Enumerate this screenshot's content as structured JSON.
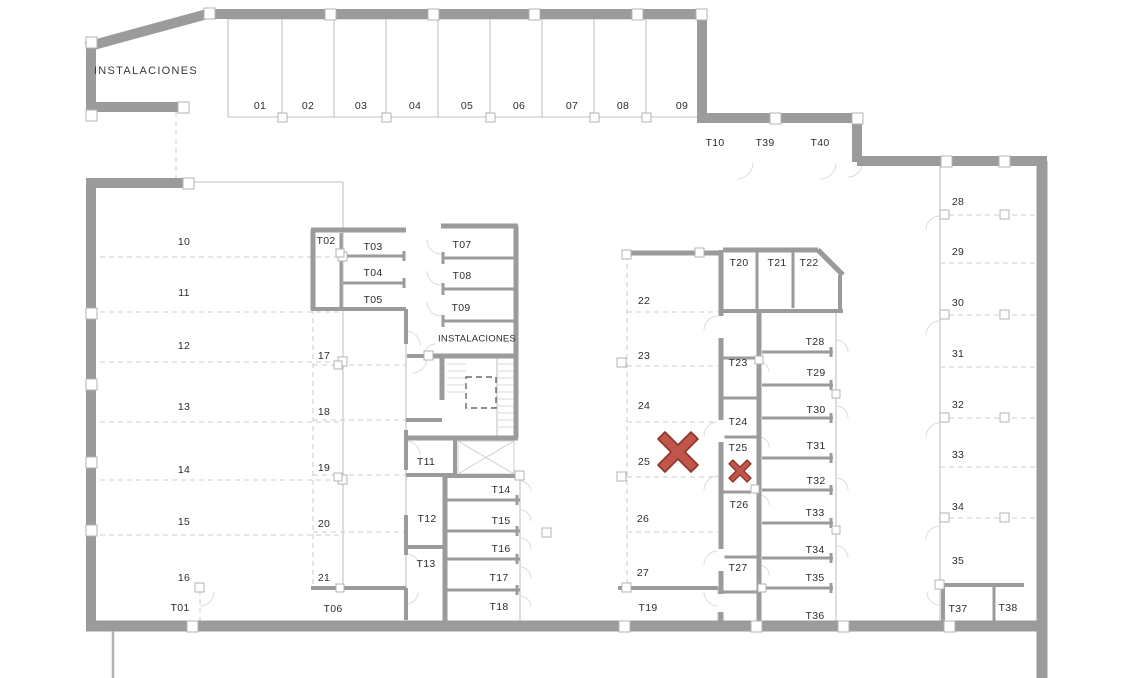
{
  "colors": {
    "wall": "#9b9b9b",
    "thin_line": "#c2c2c2",
    "marker_fill": "#c0564b",
    "marker_stroke": "#8d362d"
  },
  "labels": {
    "instalaciones_top": "INSTALACIONES",
    "instalaciones_mid": "INSTALACIONES",
    "p01": "01",
    "p02": "02",
    "p03": "03",
    "p04": "04",
    "p05": "05",
    "p06": "06",
    "p07": "07",
    "p08": "08",
    "p09": "09",
    "p10": "10",
    "p11": "11",
    "p12": "12",
    "p13": "13",
    "p14": "14",
    "p15": "15",
    "p16": "16",
    "p17": "17",
    "p18": "18",
    "p19": "19",
    "p20": "20",
    "p21": "21",
    "p22": "22",
    "p23": "23",
    "p24": "24",
    "p25": "25",
    "p26": "26",
    "p27": "27",
    "p28": "28",
    "p29": "29",
    "p30": "30",
    "p31": "31",
    "p32": "32",
    "p33": "33",
    "p34": "34",
    "p35": "35",
    "t01": "T01",
    "t02": "T02",
    "t03": "T03",
    "t04": "T04",
    "t05": "T05",
    "t06": "T06",
    "t07": "T07",
    "t08": "T08",
    "t09": "T09",
    "t10": "T10",
    "t11": "T11",
    "t12": "T12",
    "t13": "T13",
    "t14": "T14",
    "t15": "T15",
    "t16": "T16",
    "t17": "T17",
    "t18": "T18",
    "t19": "T19",
    "t20": "T20",
    "t21": "T21",
    "t22": "T22",
    "t23": "T23",
    "t24": "T24",
    "t25": "T25",
    "t26": "T26",
    "t27": "T27",
    "t28": "T28",
    "t29": "T29",
    "t30": "T30",
    "t31": "T31",
    "t32": "T32",
    "t33": "T33",
    "t34": "T34",
    "t35": "T35",
    "t36": "T36",
    "t37": "T37",
    "t38": "T38",
    "t39": "T39",
    "t40": "T40"
  },
  "markers": {
    "large_x_marks": "25",
    "small_x_marks": "T25"
  }
}
